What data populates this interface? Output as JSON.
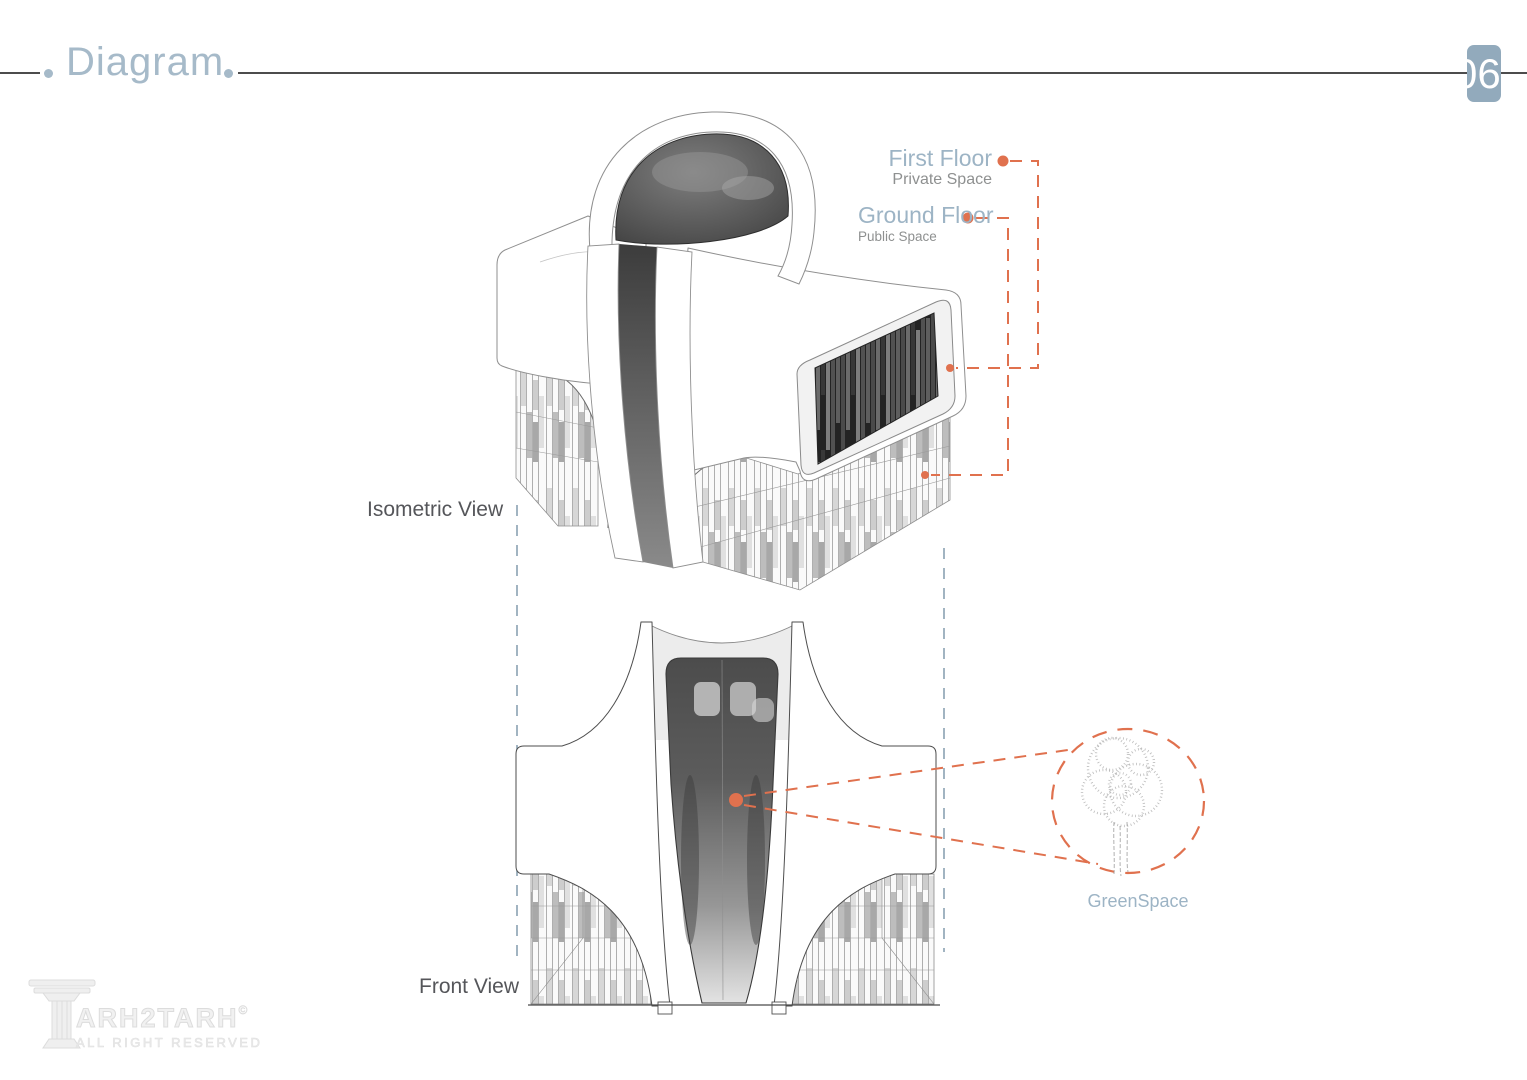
{
  "header": {
    "title": "Diagram",
    "page_number": "06"
  },
  "views": {
    "isometric_label": "Isometric View",
    "front_label": "Front View"
  },
  "annotations": {
    "first_floor": {
      "label": "First Floor",
      "sublabel": "Private Space"
    },
    "ground_floor": {
      "label": "Ground Floor",
      "sublabel": "Public Space"
    },
    "greenspace": {
      "label": "GreenSpace"
    }
  },
  "watermark": {
    "brand": "ARH2TARH",
    "copyright_symbol": "©",
    "tagline": "ALL RIGHT RESERVED"
  },
  "colors": {
    "accent_orange": "#e0714e",
    "heading_blue": "#a6bac9",
    "badge_blue": "#92aabc",
    "guide_blue": "#8aa2b2",
    "sublabel_gray": "#8e9090",
    "view_label_gray": "#55565a"
  }
}
